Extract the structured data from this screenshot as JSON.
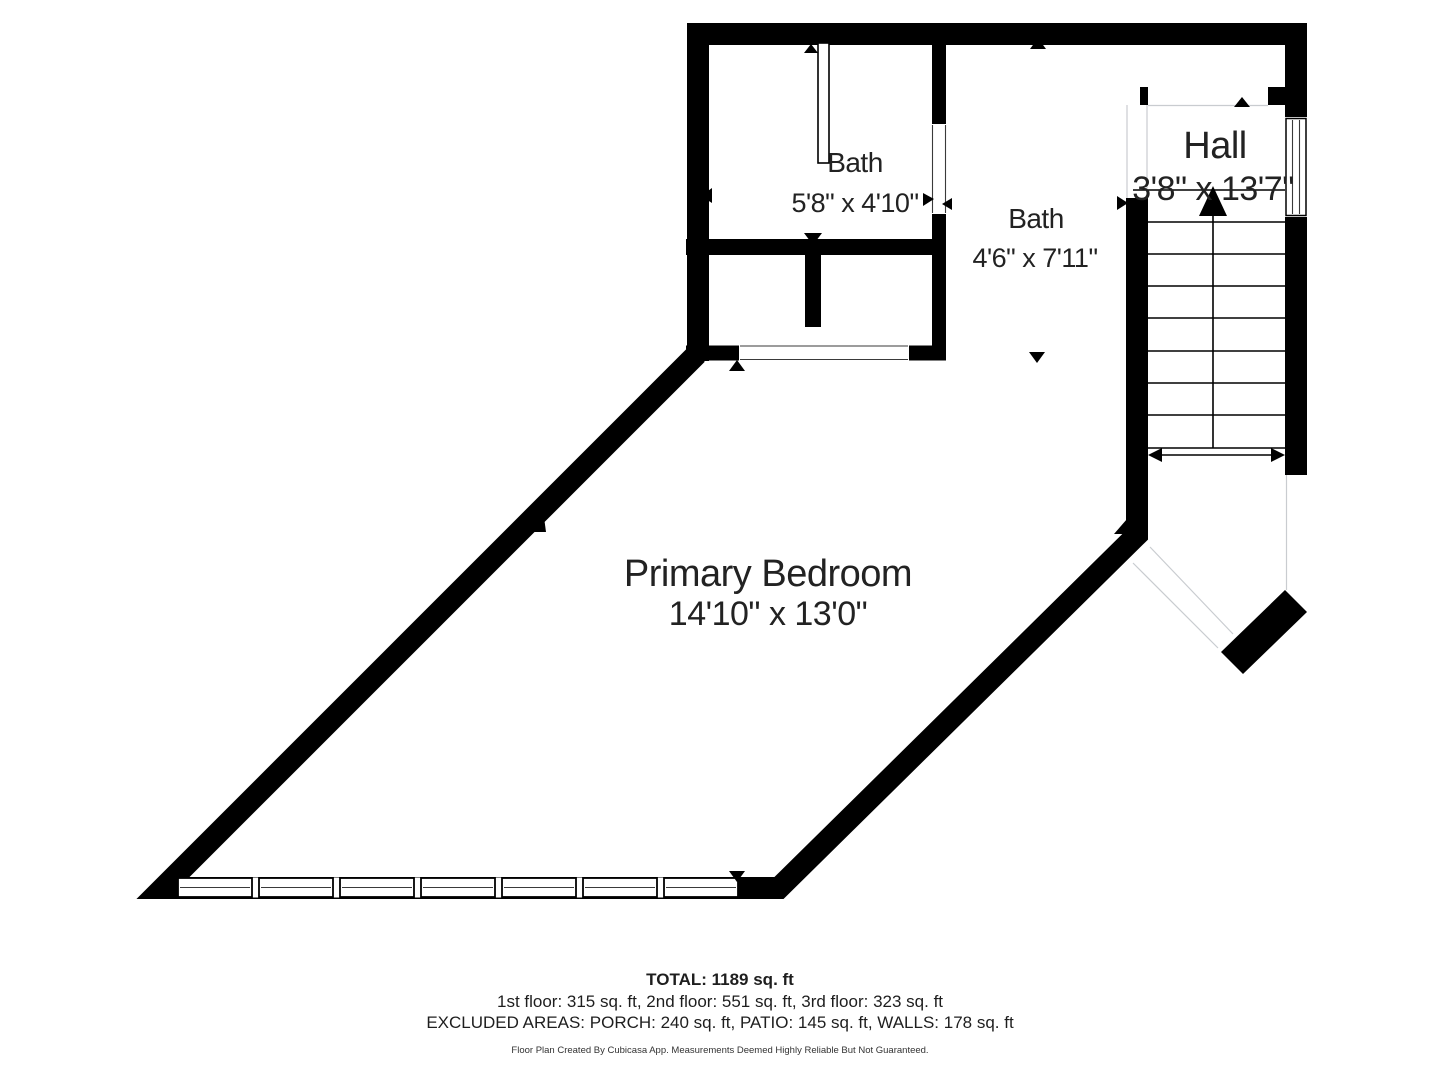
{
  "plan": {
    "rooms": [
      {
        "id": "bath-1",
        "name": "Bath",
        "dims": "5'8\" x 4'10\""
      },
      {
        "id": "bath-2",
        "name": "Bath",
        "dims": "4'6\" x 7'11\""
      },
      {
        "id": "hall",
        "name": "Hall",
        "dims": "3'8\" x 13'7\""
      },
      {
        "id": "primary-bedroom",
        "name": "Primary Bedroom",
        "dims": "14'10\" x 13'0\""
      }
    ],
    "stairs": {
      "direction": "up",
      "tread_count": 8
    }
  },
  "footer": {
    "total": "TOTAL: 1189 sq. ft",
    "floors": "1st floor: 315 sq. ft, 2nd floor: 551 sq. ft, 3rd floor: 323 sq. ft",
    "excluded": "EXCLUDED AREAS: PORCH: 240 sq. ft, PATIO: 145 sq. ft, WALLS: 178 sq. ft",
    "disclaimer": "Floor Plan Created By Cubicasa App. Measurements Deemed Highly Reliable But Not Guaranteed."
  },
  "colors": {
    "wall": "#000000",
    "text": "#222222",
    "light_line": "#c9ccd0",
    "background": "#ffffff"
  }
}
